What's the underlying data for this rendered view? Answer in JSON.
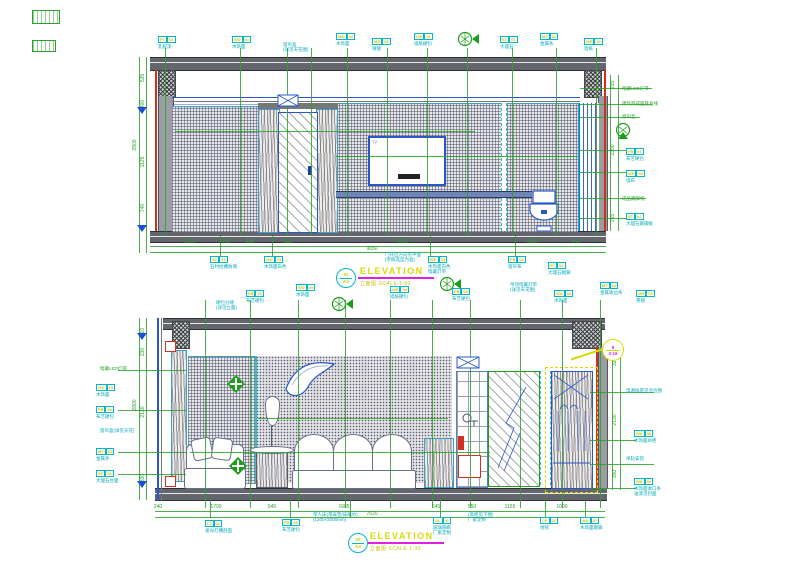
{
  "titles": {
    "top": {
      "circle_top": "01",
      "circle_bottom": "A3",
      "label": "ELEVATION",
      "subtitle": "立面图  SCALE 1:30"
    },
    "bottom": {
      "circle_top": "02",
      "circle_bottom": "A3",
      "label": "ELEVATION",
      "subtitle": "立面图  SCALE 1:30"
    }
  },
  "top_elevation": {
    "fixtures": {
      "tv_label": "TV"
    },
    "tags_top": [
      {
        "x": 158,
        "y": 36,
        "code": "PT-01",
        "desc": "乳胶漆"
      },
      {
        "x": 232,
        "y": 36,
        "code": "WD-01",
        "desc": "木饰面"
      },
      {
        "x": 283,
        "y": 42,
        "desc": "窗帘盒\n(详见天花图)"
      },
      {
        "x": 336,
        "y": 33,
        "code": "WD-02",
        "desc": "木饰面"
      },
      {
        "x": 372,
        "y": 38,
        "code": "MR-01",
        "desc": "银镜"
      },
      {
        "x": 414,
        "y": 33,
        "code": "WP-01",
        "desc": "墙纸硬包"
      },
      {
        "x": 500,
        "y": 36,
        "code": "ST-01",
        "desc": "大理石"
      },
      {
        "x": 540,
        "y": 33,
        "code": "MT-01",
        "desc": "金属条"
      },
      {
        "x": 584,
        "y": 38,
        "code": "WP-02",
        "desc": "墙纸"
      }
    ],
    "tags_right": [
      {
        "x": 622,
        "y": 86,
        "desc": "暗藏LED灯带",
        "g": true
      },
      {
        "x": 622,
        "y": 101,
        "desc": "建筑完成面基准线",
        "g": true
      },
      {
        "x": 622,
        "y": 114,
        "desc": "窗帘盒",
        "g": true
      },
      {
        "x": 626,
        "y": 148,
        "code": "FB-01",
        "desc": "布艺硬包"
      },
      {
        "x": 626,
        "y": 170,
        "code": "WP-03",
        "desc": "墙布"
      },
      {
        "x": 622,
        "y": 196,
        "desc": "成品踢脚线",
        "g": true
      },
      {
        "x": 626,
        "y": 213,
        "code": "ST-02",
        "desc": "大理石踢脚板"
      }
    ],
    "tags_bottom": [
      {
        "x": 210,
        "y": 256,
        "code": "ST-03",
        "desc": "石材拉槽防滑"
      },
      {
        "x": 264,
        "y": 256,
        "code": "WD-03",
        "desc": "木饰面白色"
      },
      {
        "x": 385,
        "y": 252,
        "desc": "门开启方向见平面\n(参照选型为准)"
      },
      {
        "x": 428,
        "y": 256,
        "code": "WD-04",
        "desc": "木饰面白色\n暗藏灯带"
      },
      {
        "x": 508,
        "y": 256,
        "code": "FB-02",
        "desc": "窗帘布"
      },
      {
        "x": 548,
        "y": 262,
        "code": "ST-02",
        "desc": "大理石踢脚"
      }
    ],
    "dims_bottom": [
      {
        "x": 190,
        "y": 242,
        "t": "1310"
      },
      {
        "x": 226,
        "y": 242,
        "t": "450"
      },
      {
        "x": 250,
        "y": 242,
        "t": "850"
      },
      {
        "x": 288,
        "y": 242,
        "t": "500"
      },
      {
        "x": 402,
        "y": 242,
        "t": "4350"
      },
      {
        "x": 532,
        "y": 242,
        "t": "1650"
      },
      {
        "x": 576,
        "y": 242,
        "t": "540"
      }
    ],
    "dims_bottom_total": {
      "x": 372,
      "y": 249,
      "t": "9650"
    },
    "dims_left": [
      {
        "x": 143,
        "y": 78,
        "t": "535"
      },
      {
        "x": 143,
        "y": 104,
        "t": "400"
      },
      {
        "x": 143,
        "y": 162,
        "t": "1125"
      },
      {
        "x": 143,
        "y": 208,
        "t": "740"
      }
    ],
    "dims_left_total": {
      "x": 135,
      "y": 145,
      "t": "2800"
    },
    "dims_right": [
      {
        "x": 613,
        "y": 85,
        "t": "235"
      },
      {
        "x": 613,
        "y": 150,
        "t": "2350"
      },
      {
        "x": 613,
        "y": 218,
        "t": "215"
      }
    ]
  },
  "bottom_elevation": {
    "callout": {
      "top": "8",
      "bottom": "3-16"
    },
    "tags_top": [
      {
        "x": 216,
        "y": 300,
        "desc": "硬包分缝\n(详见立面)"
      },
      {
        "x": 246,
        "y": 290,
        "code": "FB-03",
        "desc": "布艺硬包"
      },
      {
        "x": 296,
        "y": 284,
        "code": "WD-05",
        "desc": "木饰面"
      },
      {
        "x": 390,
        "y": 286,
        "code": "WP-04",
        "desc": "墙纸硬包"
      },
      {
        "x": 452,
        "y": 288,
        "code": "FB-04",
        "desc": "布艺硬包"
      },
      {
        "x": 510,
        "y": 282,
        "desc": "吊顶暗藏灯带\n(详见天花图)"
      },
      {
        "x": 554,
        "y": 290,
        "code": "WD-06",
        "desc": "木饰面"
      },
      {
        "x": 600,
        "y": 282,
        "code": "MT-02",
        "desc": "金属收边条"
      },
      {
        "x": 636,
        "y": 290,
        "code": "MR-02",
        "desc": "茶镜"
      }
    ],
    "tags_left": [
      {
        "x": 100,
        "y": 366,
        "desc": "暗藏LED灯带",
        "g": true
      },
      {
        "x": 96,
        "y": 384,
        "code": "WD-10",
        "desc": "木饰面"
      },
      {
        "x": 96,
        "y": 406,
        "code": "FB-06",
        "desc": "布艺硬包"
      },
      {
        "x": 100,
        "y": 428,
        "desc": "窗帘盒(详见天花)"
      },
      {
        "x": 96,
        "y": 448,
        "code": "MT-03",
        "desc": "金属条"
      },
      {
        "x": 96,
        "y": 470,
        "code": "ST-04",
        "desc": "大理石台面"
      }
    ],
    "tags_right": [
      {
        "x": 626,
        "y": 388,
        "desc": "电源插座见点位图"
      },
      {
        "x": 634,
        "y": 430,
        "code": "WD-08",
        "desc": "木饰面吊柜"
      },
      {
        "x": 626,
        "y": 456,
        "desc": "吊轨安装"
      },
      {
        "x": 634,
        "y": 478,
        "code": "WD-09",
        "desc": "木饰面收口条\n油漆见封面"
      }
    ],
    "tags_bottom": [
      {
        "x": 205,
        "y": 520,
        "code": "LT-01",
        "desc": "发光灯槽剖面"
      },
      {
        "x": 282,
        "y": 519,
        "code": "FB-05",
        "desc": "布艺硬包"
      },
      {
        "x": 313,
        "y": 512,
        "desc": "单人床(带床垫/床尾巾)\n(1200×2000mm)"
      },
      {
        "x": 433,
        "y": 517,
        "code": "GL-01",
        "desc": "玻璃隔断\n厂家定制"
      },
      {
        "x": 468,
        "y": 512,
        "desc": "(高柜见下图)\n厂家定制"
      },
      {
        "x": 540,
        "y": 517,
        "code": "CP-01",
        "desc": "地毯"
      },
      {
        "x": 580,
        "y": 517,
        "code": "WD-07",
        "desc": "木饰面踢脚"
      }
    ],
    "dims_bottom": [
      {
        "x": 158,
        "y": 507,
        "t": "240"
      },
      {
        "x": 216,
        "y": 507,
        "t": "1700"
      },
      {
        "x": 272,
        "y": 507,
        "t": "645"
      },
      {
        "x": 344,
        "y": 507,
        "t": "1685"
      },
      {
        "x": 436,
        "y": 507,
        "t": "645"
      },
      {
        "x": 472,
        "y": 507,
        "t": "550"
      },
      {
        "x": 510,
        "y": 507,
        "t": "1155"
      },
      {
        "x": 562,
        "y": 507,
        "t": "1000"
      }
    ],
    "dims_bottom_total": {
      "x": 372,
      "y": 514,
      "t": "7620"
    },
    "dims_left": [
      {
        "x": 143,
        "y": 332,
        "t": "110"
      },
      {
        "x": 143,
        "y": 352,
        "t": "230"
      },
      {
        "x": 143,
        "y": 412,
        "t": "2130"
      },
      {
        "x": 143,
        "y": 478,
        "t": "330"
      }
    ],
    "dims_left_total": {
      "x": 135,
      "y": 405,
      "t": "2800"
    },
    "dims_right": [
      {
        "x": 615,
        "y": 362,
        "t": "320"
      },
      {
        "x": 615,
        "y": 420,
        "t": "2130"
      },
      {
        "x": 615,
        "y": 474,
        "t": "350"
      }
    ]
  }
}
